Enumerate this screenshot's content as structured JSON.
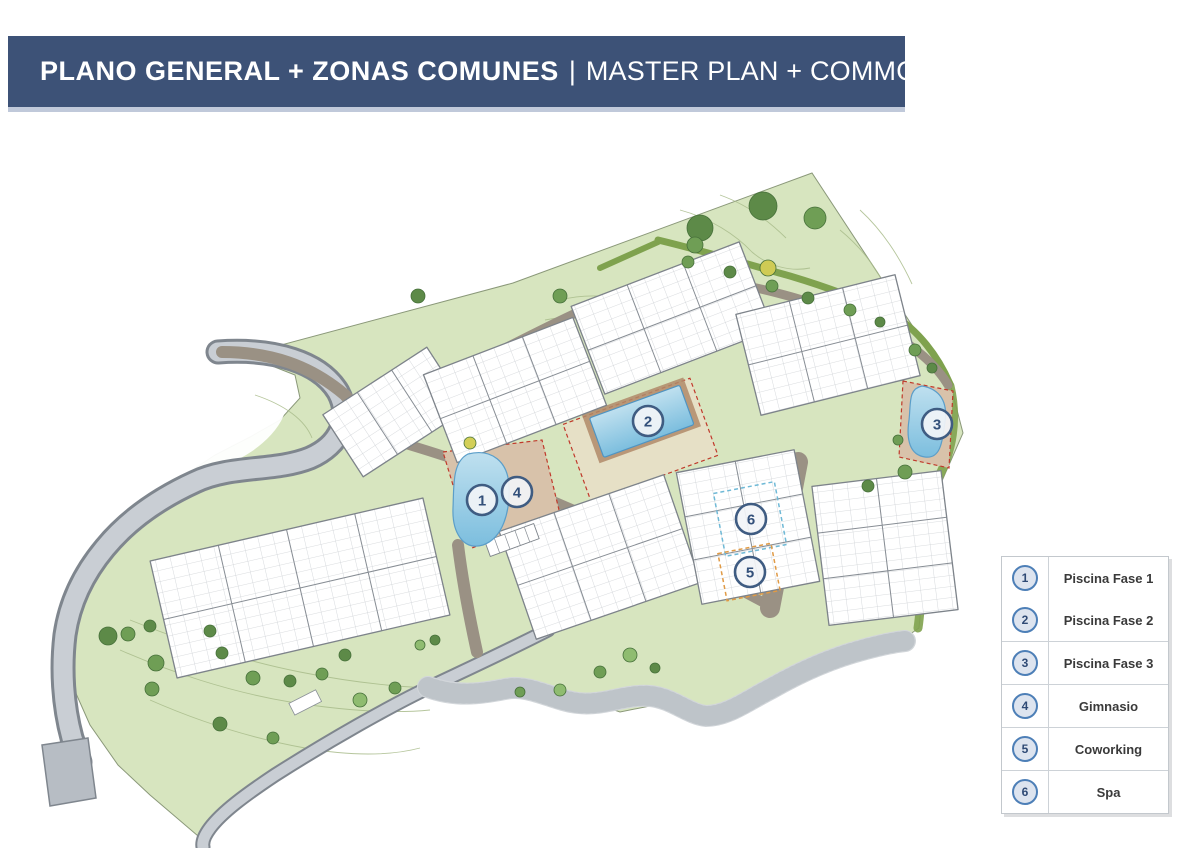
{
  "header": {
    "title_es": "PLANO GENERAL + ZONAS COMUNES",
    "separator": "|",
    "title_en": "MASTER PLAN + COMMON AREAS",
    "bg_color": "#3d5277",
    "underline_color": "#c0c9da",
    "text_color": "#ffffff"
  },
  "legend": {
    "items": [
      {
        "number": "1",
        "label": "Piscina Fase 1"
      },
      {
        "number": "2",
        "label": "Piscina Fase 2"
      },
      {
        "number": "3",
        "label": "Piscina Fase 3"
      },
      {
        "number": "4",
        "label": "Gimnasio"
      },
      {
        "number": "5",
        "label": "Coworking"
      },
      {
        "number": "6",
        "label": "Spa"
      }
    ],
    "ring_color": "#4d7fb7",
    "circle_fill": "#dde4ef",
    "number_color": "#2f4a75",
    "label_color": "#3a3a3a"
  },
  "plan": {
    "markers": [
      {
        "number": "1",
        "refers_to": "Piscina Fase 1"
      },
      {
        "number": "2",
        "refers_to": "Piscina Fase 2"
      },
      {
        "number": "3",
        "refers_to": "Piscina Fase 3"
      },
      {
        "number": "4",
        "refers_to": "Gimnasio"
      },
      {
        "number": "5",
        "refers_to": "Coworking"
      },
      {
        "number": "6",
        "refers_to": "Spa"
      }
    ],
    "colors": {
      "terrain_green": "#d7e5bf",
      "contour_line": "#a9bc8b",
      "path_olive": "#7fa24e",
      "road_gray": "#c9ced4",
      "road_casing": "#7f868e",
      "internal_road_brown": "#9a9184",
      "building_white": "#ffffff",
      "building_outline": "#7d838a",
      "pool_blue": "#a9d4ea",
      "pool_edge": "#5b9ec9",
      "deck_tan": "#d8c2aa",
      "plot_boundary_dash_red": "#c0392b",
      "spa_zone_dash": "#6fb9d6",
      "coworking_zone_dash": "#e09a45",
      "marker_ring": "#3f5c82",
      "marker_fill": "#f2f4f7",
      "tree_green": "#5d8a48"
    }
  }
}
